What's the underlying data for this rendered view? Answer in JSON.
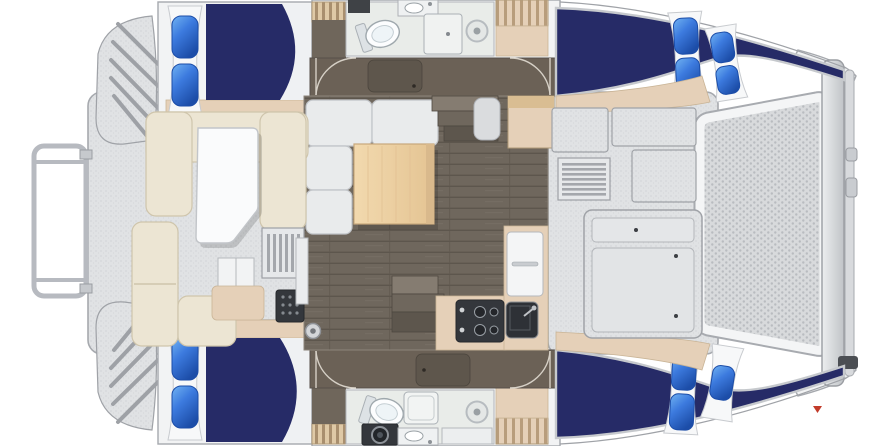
{
  "image": {
    "kind": "3D-rendered catamaran yacht floor plan, top-down deck and accommodation view",
    "vessel": "sailing catamaran, 4 cabins, 2 heads, bridgedeck salon",
    "orientation": "bow at right (trampoline and crossbeam), stern at left (cockpit and transom steps)",
    "visible_text": "none"
  },
  "colors": {
    "background": "#ffffff",
    "hull_white": "#f2f3f4",
    "outline": "#a6a9ae",
    "berth_navy": "#262b67",
    "pillow_blue": "#3c7ade",
    "pillow_blue_dark": "#1c4da8",
    "panel_white": "#f7f8f9",
    "shelf_tan": "#e5d0b8",
    "bench_cream": "#ece5d3",
    "salon_floor": "#6f675d",
    "wardrobe_brown": "#6b6156",
    "bath_floor": "#e9ece9",
    "appliance_dark": "#34373c",
    "table_wood": "#eed4a9",
    "trampoline_base": "#d8dadc",
    "watermark_red": "#c23b2a"
  },
  "stern": {
    "features": [
      "stern rail",
      "port transom step platform",
      "starboard transom step platform"
    ]
  },
  "cockpit": {
    "furniture": [
      "U-shaped bench with white table",
      "corner bench",
      "aft bench",
      "side table",
      "storage boxes",
      "louvered vent",
      "grill box",
      "winch"
    ]
  },
  "port_hull": {
    "aft_cabin": {
      "berth": "double berth, navy spread",
      "pillows": 2
    },
    "head": {
      "fixtures": [
        "vanity",
        "toilet",
        "sink",
        "shower stall",
        "shower drain"
      ]
    },
    "companionway": "steps",
    "lockers": [
      "shelved locker",
      "wardrobe band with two doors"
    ],
    "forward_cabin": {
      "berth": "double berth tapering into bow",
      "pillows": 4
    }
  },
  "starboard_hull": {
    "aft_cabin": {
      "berth": "double berth, navy spread",
      "pillows": 2
    },
    "head": {
      "fixtures": [
        "toilet",
        "washer",
        "sink",
        "shower tray",
        "shower drain",
        "counter"
      ]
    },
    "companionway": "steps",
    "lockers": [
      "shelved locker",
      "wardrobe band with two doors"
    ],
    "forward_cabin": {
      "berth": "double berth tapering into bow",
      "pillows": 3
    }
  },
  "salon": {
    "furniture": [
      "L-shaped settee",
      "wood dining table",
      "nav seat",
      "sideboard cabinet",
      "steps down to port hull",
      "steps down to starboard hull"
    ]
  },
  "galley": {
    "appliances": [
      "two-burner cooktop with knobs",
      "refrigerator with handle",
      "dark sink with faucet"
    ],
    "position": "aft starboard corner of salon"
  },
  "foredeck": {
    "features": [
      "raised deck lockers",
      "louvered vent",
      "large deck hatch with fasteners",
      "trampoline mesh",
      "forward crossbeam",
      "crossbeam cleats",
      "bow tips"
    ]
  },
  "watermark": {
    "glyph": "tiny red down-arrow",
    "position": "lower right, near starboard bow"
  }
}
